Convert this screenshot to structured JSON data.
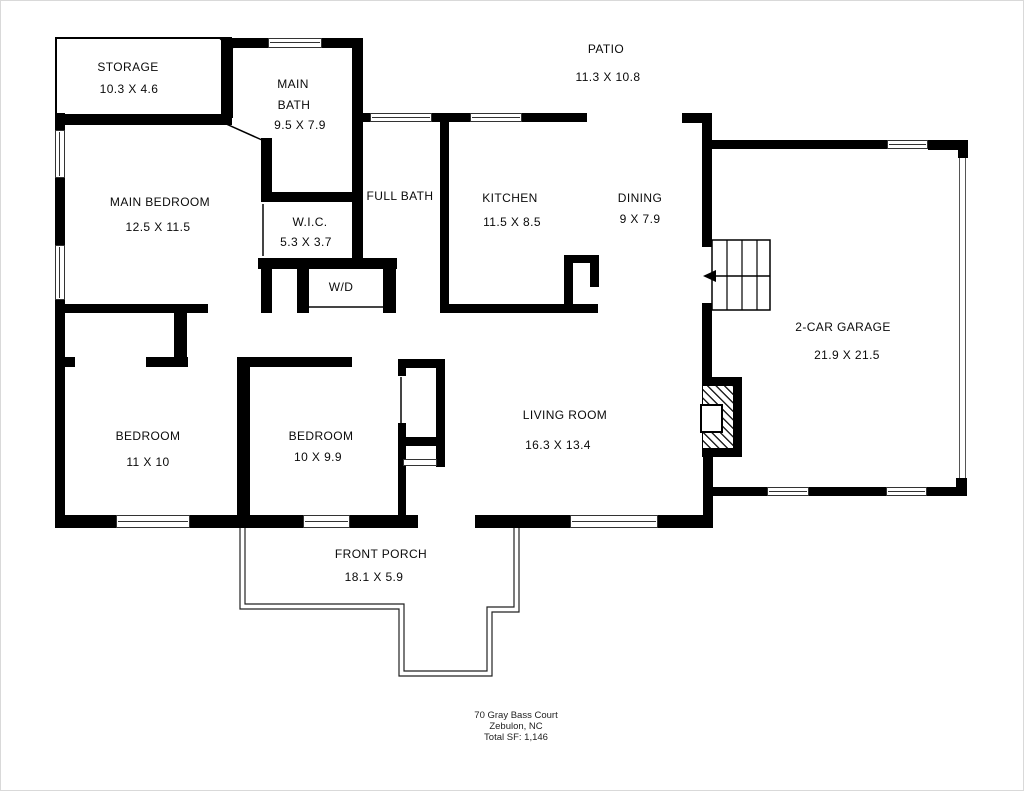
{
  "rooms": {
    "storage": {
      "name": "STORAGE",
      "dims": "10.3 X 4.6"
    },
    "main_bath": {
      "line1": "MAIN",
      "line2": "BATH",
      "dims": "9.5 X 7.9"
    },
    "patio": {
      "name": "PATIO",
      "dims": "11.3 X 10.8"
    },
    "main_bedroom": {
      "name": "MAIN BEDROOM",
      "dims": "12.5 X 11.5"
    },
    "full_bath": {
      "name": "FULL BATH"
    },
    "wic": {
      "name": "W.I.C.",
      "dims": "5.3 X 3.7"
    },
    "laundry": {
      "name": "W/D"
    },
    "kitchen": {
      "name": "KITCHEN",
      "dims": "11.5 X 8.5"
    },
    "dining": {
      "name": "DINING",
      "dims": "9 X 7.9"
    },
    "garage": {
      "name": "2-CAR GARAGE",
      "dims": "21.9 X 21.5"
    },
    "living_room": {
      "name": "LIVING ROOM",
      "dims": "16.3 X 13.4"
    },
    "bedroom_left": {
      "name": "BEDROOM",
      "dims": "11 X 10"
    },
    "bedroom_middle": {
      "name": "BEDROOM",
      "dims": "10 X 9.9"
    },
    "front_porch": {
      "name": "FRONT PORCH",
      "dims": "18.1 X 5.9"
    }
  },
  "footer": {
    "address_line1": "70 Gray Bass Court",
    "address_line2": "Zebulon, NC",
    "total_sf": "Total SF: 1,146"
  },
  "colors": {
    "wall": "#000000",
    "background": "#ffffff",
    "thin_line": "#444444"
  }
}
